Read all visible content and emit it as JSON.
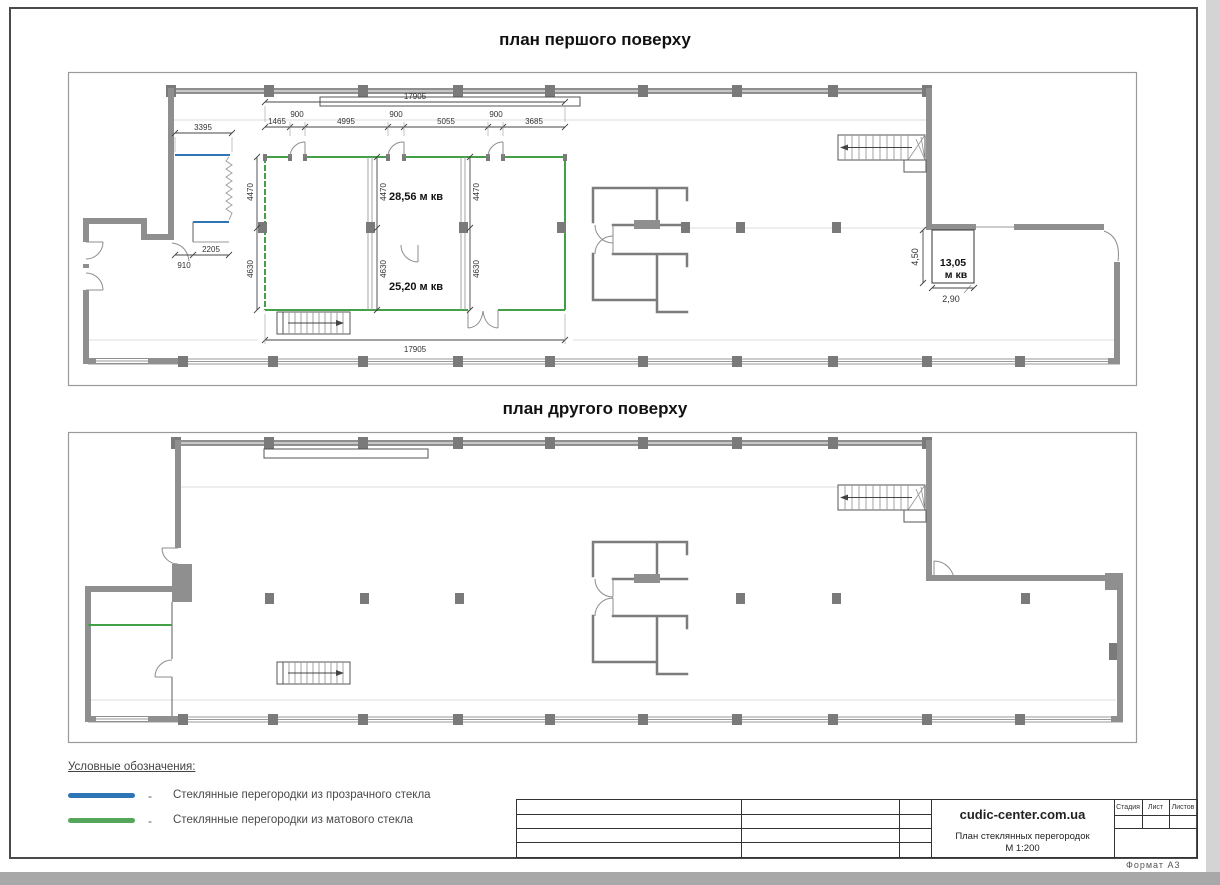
{
  "sheet": {
    "title_plan1": "план першого поверху",
    "title_plan2": "план другого поверху"
  },
  "plan1": {
    "dims": {
      "total_top": "17905",
      "total_bottom": "17905",
      "room_left": "3395",
      "chain": [
        "1465",
        "900",
        "4995",
        "900",
        "5055",
        "900",
        "3685"
      ],
      "height_upper": "4470",
      "height_lower": "4630",
      "vestibule_width": "2205",
      "vestibule_door": "910",
      "right_room_height": "4,50",
      "right_room_width": "2,90"
    },
    "areas": {
      "room1": "28,56 м кв",
      "room2": "25,20 м кв",
      "room3_value": "13,05",
      "room3_unit": "м кв"
    }
  },
  "legend": {
    "heading": "Условные обозначения:",
    "separator": "-",
    "items": [
      {
        "label": "Стеклянные перегородки из прозрачного стекла",
        "color": "#2e75b6"
      },
      {
        "label": "Стеклянные перегородки из матового стекла",
        "color": "#53a65a"
      }
    ]
  },
  "titleblock": {
    "brand": "cudic-center.com.ua",
    "doc_title": "План стеклянных перегородок",
    "doc_scale": "М 1:200",
    "columns": {
      "stage": "Стадия",
      "sheet": "Лист",
      "sheets": "Листов"
    },
    "format": "Формат А3"
  }
}
